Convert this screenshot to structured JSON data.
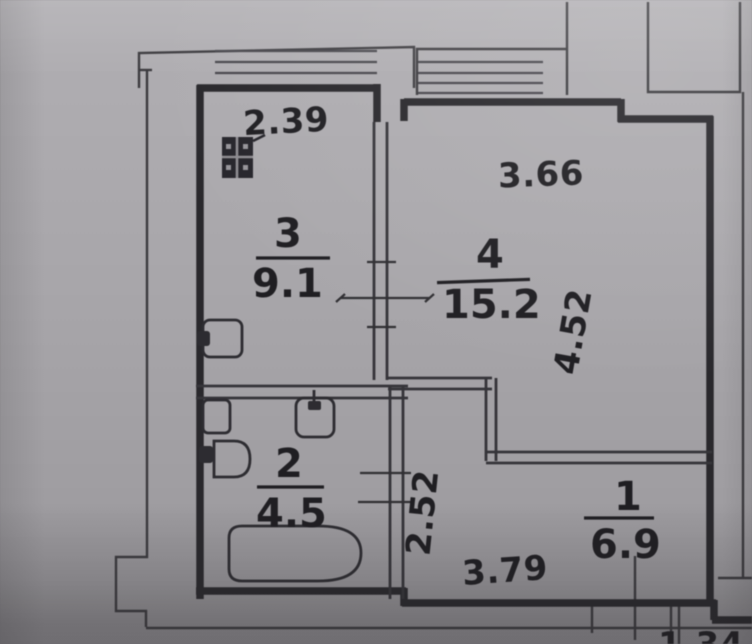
{
  "drawing": {
    "type": "apartment floor plan",
    "rooms": {
      "hall": {
        "number": "1",
        "area": "6.9"
      },
      "bath": {
        "number": "2",
        "area": "4.5"
      },
      "kitchen": {
        "number": "3",
        "area": "9.1"
      },
      "living": {
        "number": "4",
        "area": "15.2"
      }
    },
    "dimensions": {
      "kitchen_width": "2.39",
      "living_width": "3.66",
      "living_depth": "4.52",
      "hall_depth": "2.52",
      "hall_width": "3.79",
      "partial_bottom": "1.34"
    },
    "colors": {
      "paper": "#aaa8ac",
      "ink": "#232226"
    }
  }
}
